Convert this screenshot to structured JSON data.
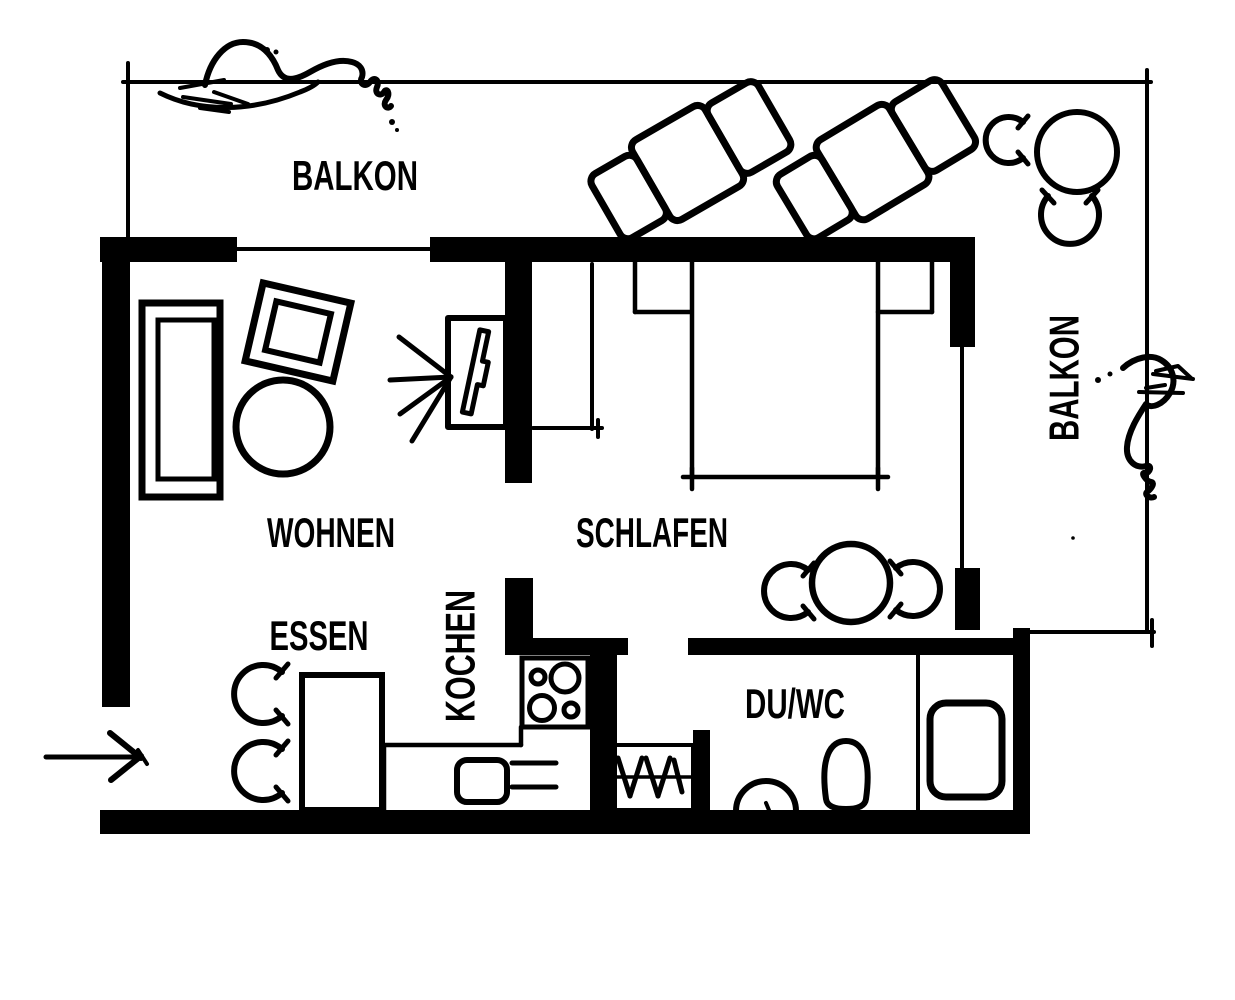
{
  "palette": {
    "ink": "#000000",
    "background": "#ffffff"
  },
  "plan": {
    "labels": {
      "balkon_top": "BALKON",
      "balkon_right": "BALKON",
      "wohnen": "WOHNEN",
      "schlafen": "SCHLAFEN",
      "essen": "ESSEN",
      "kochen": "KOCHEN",
      "du_wc": "DU/WC"
    }
  }
}
